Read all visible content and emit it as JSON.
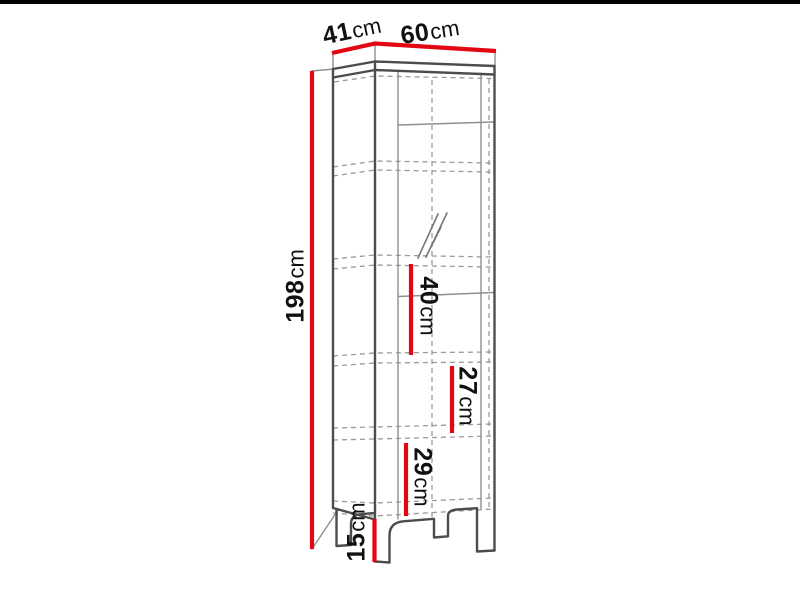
{
  "colors": {
    "dimension_red": "#e30613",
    "outline_dark": "#4c4c4c",
    "outline_light": "#8f8f8f",
    "dashed_gray": "#9a9a9a",
    "label_text": "#111111",
    "top_bar_black": "#000000"
  },
  "labels": {
    "depth": {
      "value": "41",
      "unit": "cm"
    },
    "width": {
      "value": "60",
      "unit": "cm"
    },
    "height": {
      "value": "198",
      "unit": "cm"
    },
    "glass_section_height": {
      "value": "40",
      "unit": "cm"
    },
    "middle_section_height": {
      "value": "27",
      "unit": "cm"
    },
    "lower_section_height": {
      "value": "29",
      "unit": "cm"
    },
    "leg_height": {
      "value": "15",
      "unit": "cm"
    }
  }
}
